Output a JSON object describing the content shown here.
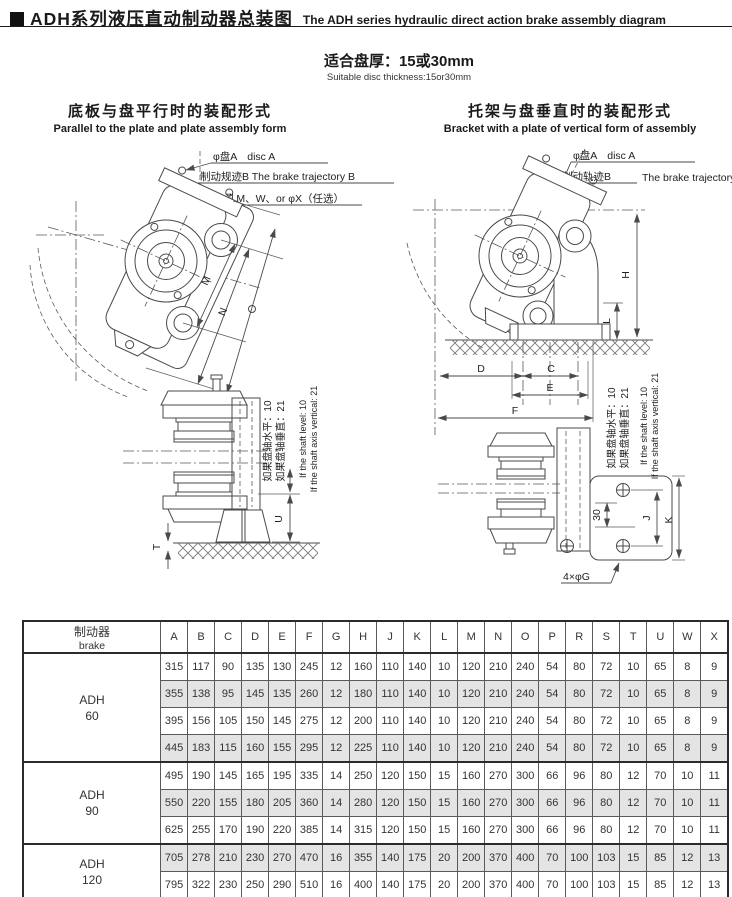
{
  "page": {
    "title_zh": "ADH系列液压直动制动器总装图",
    "title_en": "The ADH series hydraulic direct action brake assembly diagram",
    "subtitle_zh": "适合盘厚：15或30mm",
    "subtitle_en": "Suitable disc thickness:15or30mm"
  },
  "left_diagram": {
    "heading_zh": "底板与盘平行时的装配形式",
    "heading_en": "Parallel to the plate and plate assembly form",
    "label_disc": "φ盘A　disc A",
    "label_trajectory": "制动规迹B The brake trajectory B",
    "label_holes": "6孔M、W、or φX（任选）",
    "dim_m": "M",
    "dim_n": "N",
    "dim_t": "T",
    "dim_u": "U",
    "note_zh_level": "如果盘轴水平：10",
    "note_zh_vertical": "如果盘轴垂直：21",
    "note_en_level": "If the shaft level: 10",
    "note_en_vertical": "If the shaft axis vertical: 21"
  },
  "right_diagram": {
    "heading_zh": "托架与盘垂直时的装配形式",
    "heading_en": "Bracket with a plate of vertical form of assembly",
    "label_disc": "φ盘A　disc A",
    "label_trajectory_zh": "制动轨迹B",
    "label_trajectory_en": "The brake trajectory B",
    "label_holes": "4×φG",
    "dim_h": "H",
    "dim_l": "L",
    "dim_d": "D",
    "dim_c": "C",
    "dim_e": "E",
    "dim_f": "F",
    "dim_j": "J",
    "dim_k": "K",
    "dim_30": "30",
    "note_zh_level": "如果盘轴水平：10",
    "note_zh_vertical": "如果盘轴垂直：21",
    "note_en_level": "If the shaft level: 10",
    "note_en_vertical": "If the shaft axis vertical: 21"
  },
  "table": {
    "header_zh": "制动器",
    "header_en": "brake",
    "columns": [
      "A",
      "B",
      "C",
      "D",
      "E",
      "F",
      "G",
      "H",
      "J",
      "K",
      "L",
      "M",
      "N",
      "O",
      "P",
      "R",
      "S",
      "T",
      "U",
      "W",
      "X"
    ],
    "groups": [
      {
        "model": "ADH",
        "size": "60",
        "rows": [
          [
            315,
            117,
            90,
            135,
            130,
            245,
            12,
            160,
            110,
            140,
            10,
            120,
            210,
            240,
            54,
            80,
            72,
            10,
            65,
            8,
            9
          ],
          [
            355,
            138,
            95,
            145,
            135,
            260,
            12,
            180,
            110,
            140,
            10,
            120,
            210,
            240,
            54,
            80,
            72,
            10,
            65,
            8,
            9
          ],
          [
            395,
            156,
            105,
            150,
            145,
            275,
            12,
            200,
            110,
            140,
            10,
            120,
            210,
            240,
            54,
            80,
            72,
            10,
            65,
            8,
            9
          ],
          [
            445,
            183,
            115,
            160,
            155,
            295,
            12,
            225,
            110,
            140,
            10,
            120,
            210,
            240,
            54,
            80,
            72,
            10,
            65,
            8,
            9
          ]
        ]
      },
      {
        "model": "ADH",
        "size": "90",
        "rows": [
          [
            495,
            190,
            145,
            165,
            195,
            335,
            14,
            250,
            120,
            150,
            15,
            160,
            270,
            300,
            66,
            96,
            80,
            12,
            70,
            10,
            11
          ],
          [
            550,
            220,
            155,
            180,
            205,
            360,
            14,
            280,
            120,
            150,
            15,
            160,
            270,
            300,
            66,
            96,
            80,
            12,
            70,
            10,
            11
          ],
          [
            625,
            255,
            170,
            190,
            220,
            385,
            14,
            315,
            120,
            150,
            15,
            160,
            270,
            300,
            66,
            96,
            80,
            12,
            70,
            10,
            11
          ]
        ]
      },
      {
        "model": "ADH",
        "size": "120",
        "rows": [
          [
            705,
            278,
            210,
            230,
            270,
            470,
            16,
            355,
            140,
            175,
            20,
            200,
            370,
            400,
            70,
            100,
            103,
            15,
            85,
            12,
            13
          ],
          [
            795,
            322,
            230,
            250,
            290,
            510,
            16,
            400,
            140,
            175,
            20,
            200,
            370,
            400,
            70,
            100,
            103,
            15,
            85,
            12,
            13
          ]
        ]
      }
    ]
  },
  "colors": {
    "shade": "#e4e4e4",
    "line": "#4a4a4a",
    "text": "#1a1a1a"
  }
}
